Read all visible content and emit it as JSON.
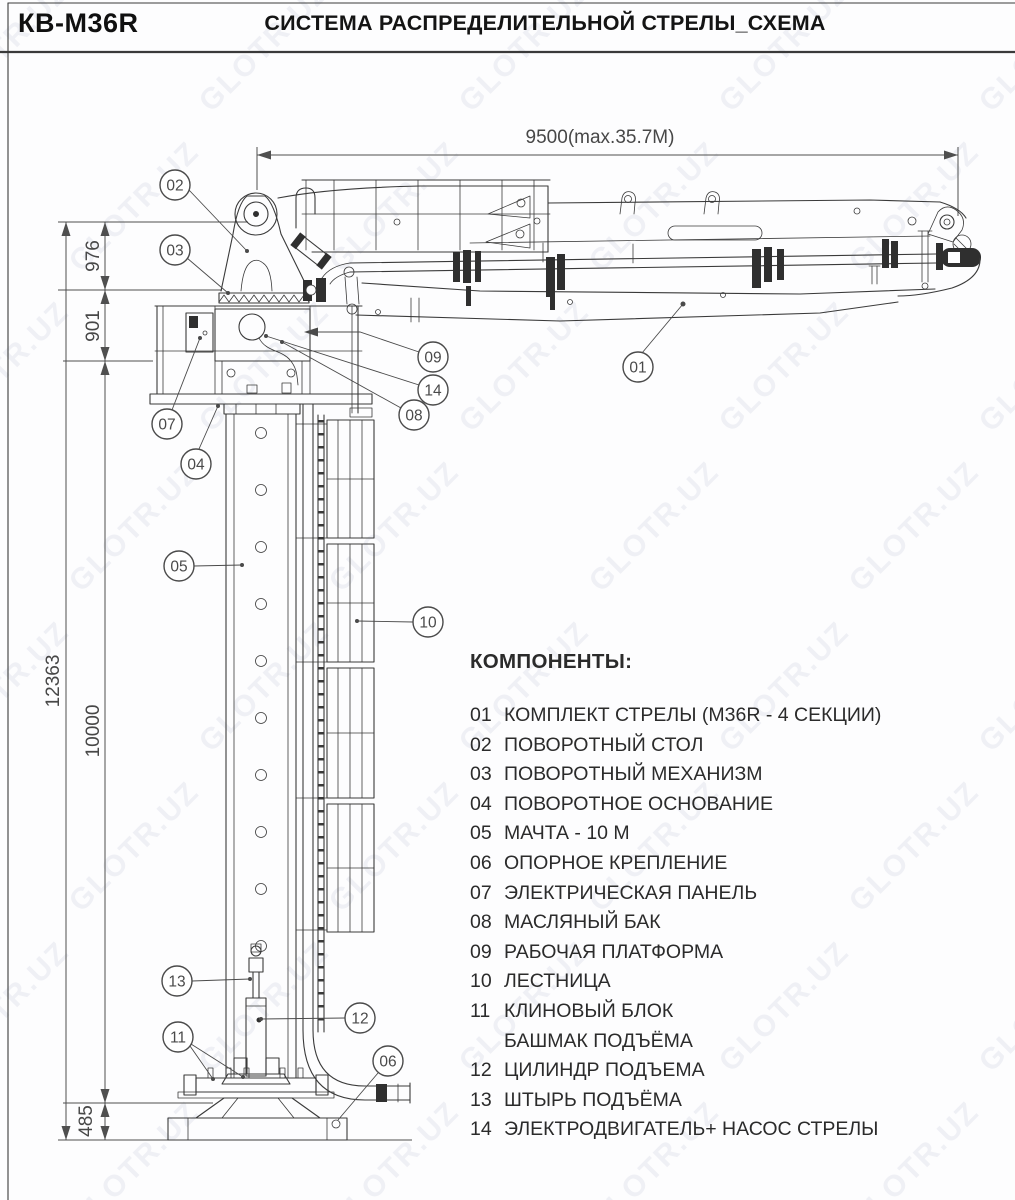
{
  "header": {
    "model": "КВ-M36R",
    "title": "СИСТЕМА РАСПРЕДЕЛИТЕЛЬНОЙ СТРЕЛЫ_СХЕМА"
  },
  "watermark": {
    "text": "GLOTR.UZ"
  },
  "diagram": {
    "dimensions": {
      "boom_length": "9500(max.35.7M)",
      "total_height": "12363",
      "turret_height": "976",
      "platform_height": "901",
      "mast_height": "10000",
      "base_height": "485"
    },
    "callouts": {
      "c01": "01",
      "c02": "02",
      "c03": "03",
      "c04": "04",
      "c05": "05",
      "c06": "06",
      "c07": "07",
      "c08": "08",
      "c09": "09",
      "c10": "10",
      "c11": "11",
      "c12": "12",
      "c13": "13",
      "c14": "14"
    }
  },
  "components": {
    "heading": "КОМПОНЕНТЫ:",
    "items": [
      {
        "num": "01",
        "label": "КОМПЛЕКТ СТРЕЛЫ (M36R - 4 СЕКЦИИ)"
      },
      {
        "num": "02",
        "label": "ПОВОРОТНЫЙ СТОЛ"
      },
      {
        "num": "03",
        "label": "ПОВОРОТНЫЙ МЕХАНИЗМ"
      },
      {
        "num": "04",
        "label": "ПОВОРОТНОЕ ОСНОВАНИЕ"
      },
      {
        "num": "05",
        "label": "МАЧТА - 10 М"
      },
      {
        "num": "06",
        "label": "ОПОРНОЕ КРЕПЛЕНИЕ"
      },
      {
        "num": "07",
        "label": "ЭЛЕКТРИЧЕСКАЯ ПАНЕЛЬ"
      },
      {
        "num": "08",
        "label": "МАСЛЯНЫЙ БАК"
      },
      {
        "num": "09",
        "label": "РАБОЧАЯ ПЛАТФОРМА"
      },
      {
        "num": "10",
        "label": "ЛЕСТНИЦА"
      },
      {
        "num": "11",
        "label": "КЛИНОВЫЙ БЛОК"
      },
      {
        "num": "",
        "label": "БАШМАК ПОДЪЁМА"
      },
      {
        "num": "12",
        "label": "ЦИЛИНДР ПОДЪЕМА"
      },
      {
        "num": "13",
        "label": "ШТЫРЬ ПОДЪЁМА"
      },
      {
        "num": "14",
        "label": "ЭЛЕКТРОДВИГАТЕЛЬ+ НАСОС СТРЕЛЫ"
      }
    ]
  },
  "colors": {
    "line": "#3a3a3a",
    "dim": "#4f4f4f",
    "watermark": "rgba(150,158,188,0.13)"
  }
}
